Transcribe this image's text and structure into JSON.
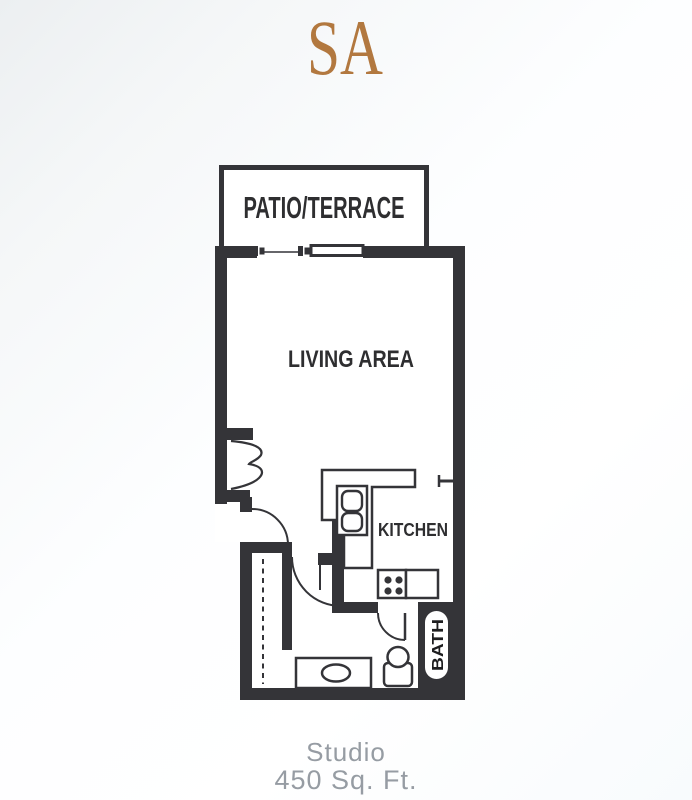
{
  "title": {
    "unit_code": "SA",
    "accent_color": "#b2783f"
  },
  "floorplan": {
    "labels": {
      "patio": "PATIO/TERRACE",
      "living_area": "LIVING AREA",
      "kitchen": "KITCHEN",
      "bath": "BATH"
    },
    "wall_color": "#343438",
    "label_color": "#2e2e30"
  },
  "caption": {
    "unit_type": "Studio",
    "area": "450 Sq. Ft.",
    "color": "#969ca3"
  }
}
